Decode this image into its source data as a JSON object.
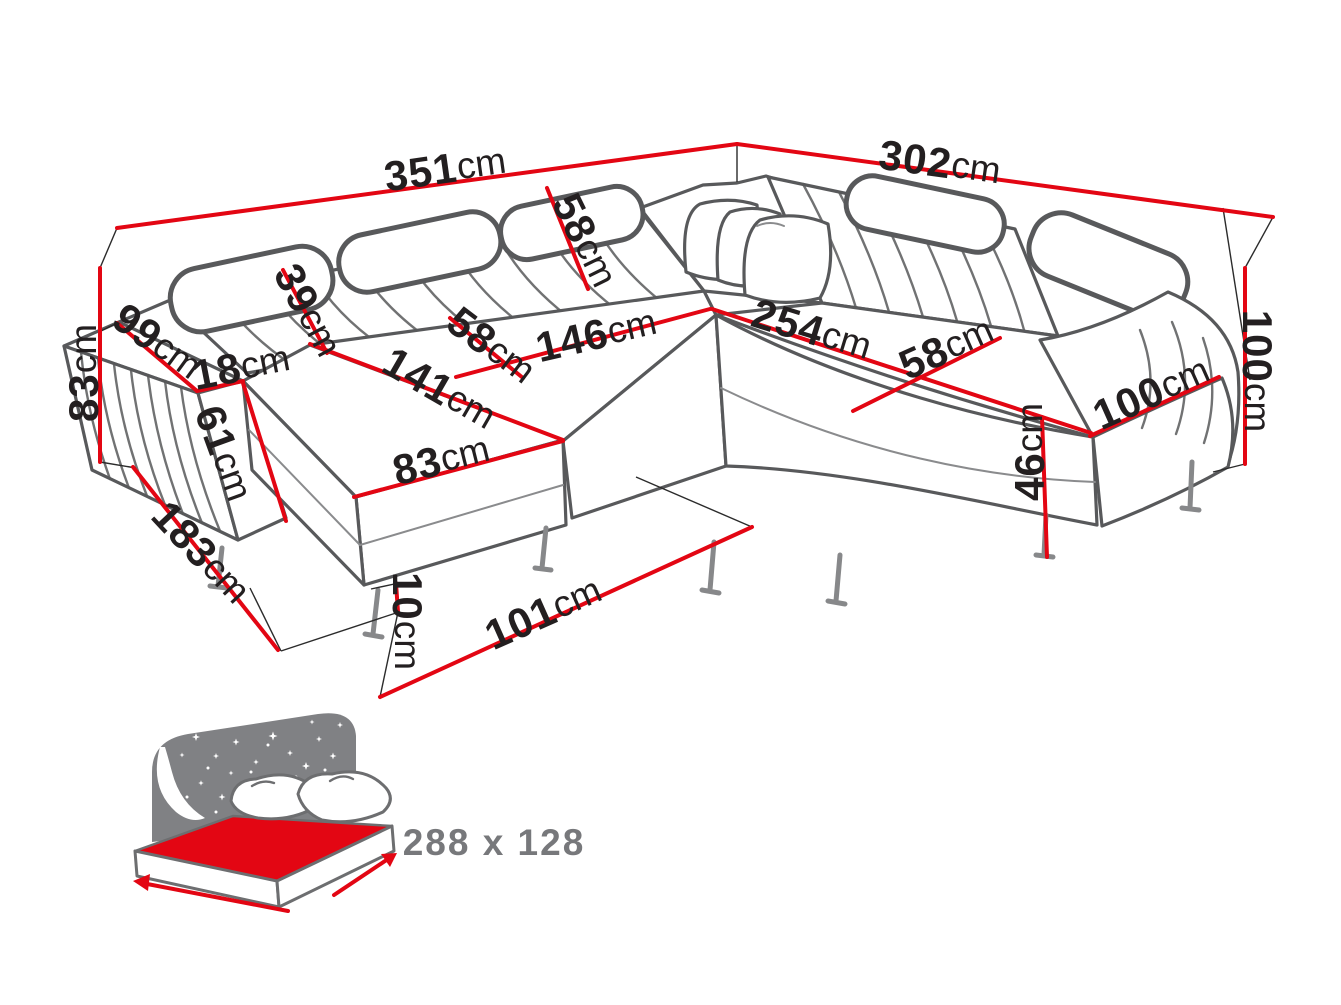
{
  "diagram_title": "corner-sofa-dimension-diagram",
  "dims": [
    {
      "name": "total-width-left",
      "value": "351",
      "unit": "cm"
    },
    {
      "name": "total-depth-right",
      "value": "302",
      "unit": "cm"
    },
    {
      "name": "total-height-left",
      "value": "83",
      "unit": "cm"
    },
    {
      "name": "backrest-height",
      "value": "58",
      "unit": "cm"
    },
    {
      "name": "headrest-height",
      "value": "39",
      "unit": "cm"
    },
    {
      "name": "armrest-depth",
      "value": "99",
      "unit": "cm"
    },
    {
      "name": "armrest-width",
      "value": "18",
      "unit": "cm"
    },
    {
      "name": "armrest-height",
      "value": "61",
      "unit": "cm"
    },
    {
      "name": "seat-depth-left",
      "value": "58",
      "unit": "cm"
    },
    {
      "name": "seat-width-left",
      "value": "146",
      "unit": "cm"
    },
    {
      "name": "seat-width-right",
      "value": "254",
      "unit": "cm"
    },
    {
      "name": "seat-depth-right",
      "value": "58",
      "unit": "cm"
    },
    {
      "name": "chaise-length",
      "value": "141",
      "unit": "cm"
    },
    {
      "name": "chaise-width",
      "value": "83",
      "unit": "cm"
    },
    {
      "name": "chaise-total-depth",
      "value": "183",
      "unit": "cm"
    },
    {
      "name": "leg-height",
      "value": "10",
      "unit": "cm"
    },
    {
      "name": "bed-extension-width",
      "value": "101",
      "unit": "cm"
    },
    {
      "name": "armrest-length-right",
      "value": "100",
      "unit": "cm"
    },
    {
      "name": "total-height-right",
      "value": "100",
      "unit": "cm"
    },
    {
      "name": "seat-height",
      "value": "46",
      "unit": "cm"
    }
  ],
  "sleeping_area": {
    "icon": "bed-with-starry-night-icon",
    "label": "288 x 128"
  },
  "colors": {
    "dimension_red": "#e30613",
    "sofa_outline": "#58595b",
    "label_ink": "#231f20",
    "icon_grey": "#808184",
    "icon_text_grey": "#77787b",
    "background": "#ffffff"
  }
}
